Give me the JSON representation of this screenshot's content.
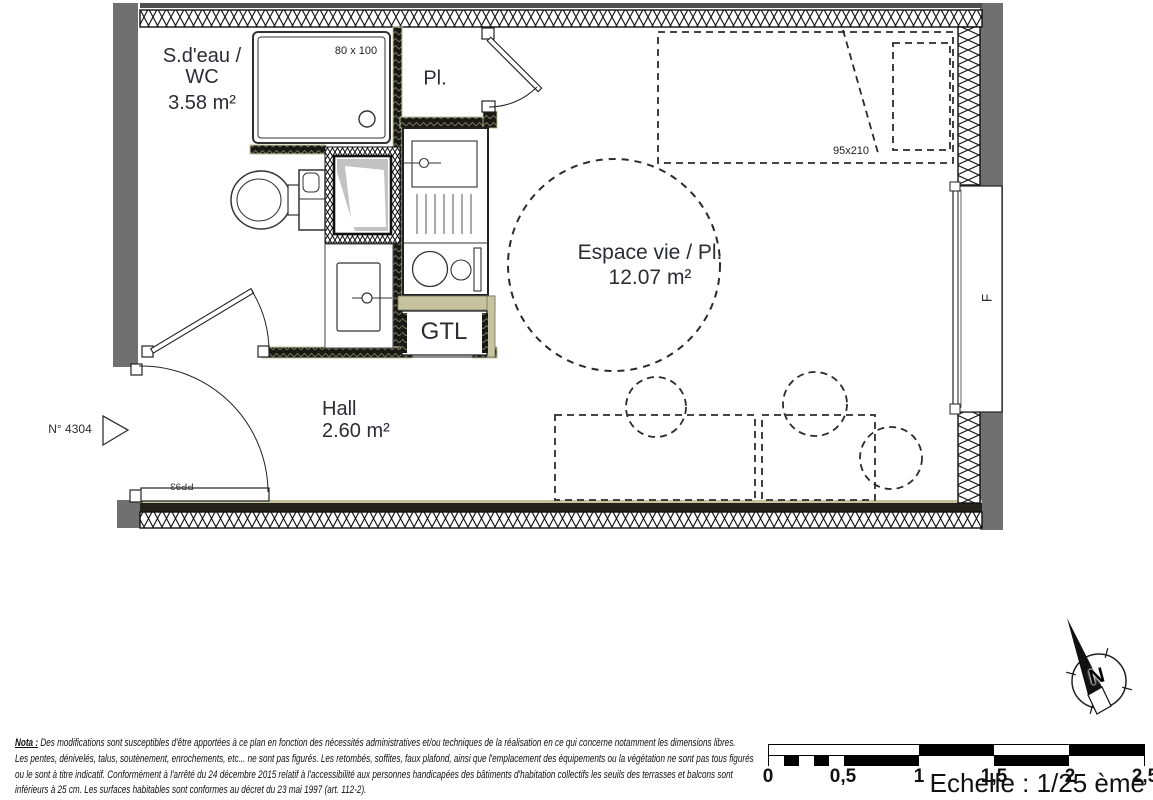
{
  "plan": {
    "rooms": {
      "bathroom": {
        "line1": "S.d'eau /",
        "line2": "WC",
        "area": "3.58 m²"
      },
      "closet": {
        "name": "Pl."
      },
      "living": {
        "name": "Espace vie / Pl.",
        "area": "12.07 m²"
      },
      "hall": {
        "name": "Hall",
        "area": "2.60 m²"
      }
    },
    "labels": {
      "gtl": "GTL",
      "shower_size": "80 x 100",
      "bed_size": "95x210",
      "entry_door_ref": "PP93",
      "unit_number": "N° 4304",
      "window": "F"
    }
  },
  "compass": {
    "north": "N"
  },
  "scalebar": {
    "labels": [
      "0",
      "0,5",
      "1",
      "1,5",
      "2",
      "2,5"
    ],
    "caption": "Echelle : 1/25 ème"
  },
  "nota": {
    "label": "Nota :",
    "line1_rest": " Des modifications sont susceptibles d'être apportées à ce plan en fonction des nécessités administratives et/ou techniques de la réalisation en ce qui concerne notamment les dimensions libres.",
    "line2": "Les pentes, dénivelés, talus, soutènement, enrochements, etc... ne sont pas figurés. Les retombés, soffites, faux plafond, ainsi que l'emplacement des équipements ou la végétation ne sont pas tous figurés",
    "line3": "ou le sont à titre indicatif. Conformément à l'arrêté du 24 décembre 2015 relatif à l'accessibilité aux personnes handicapées des bâtiments d'habitation collectifs les seuils des terrasses et balcons sont",
    "line4": "inférieurs à 25 cm. Les surfaces habitables sont conformes au décret du 23 mai 1997 (art. 112-2)."
  },
  "colors": {
    "wall_khaki": "#c5c49e",
    "outer_gray": "#707070",
    "line": "#222222"
  }
}
